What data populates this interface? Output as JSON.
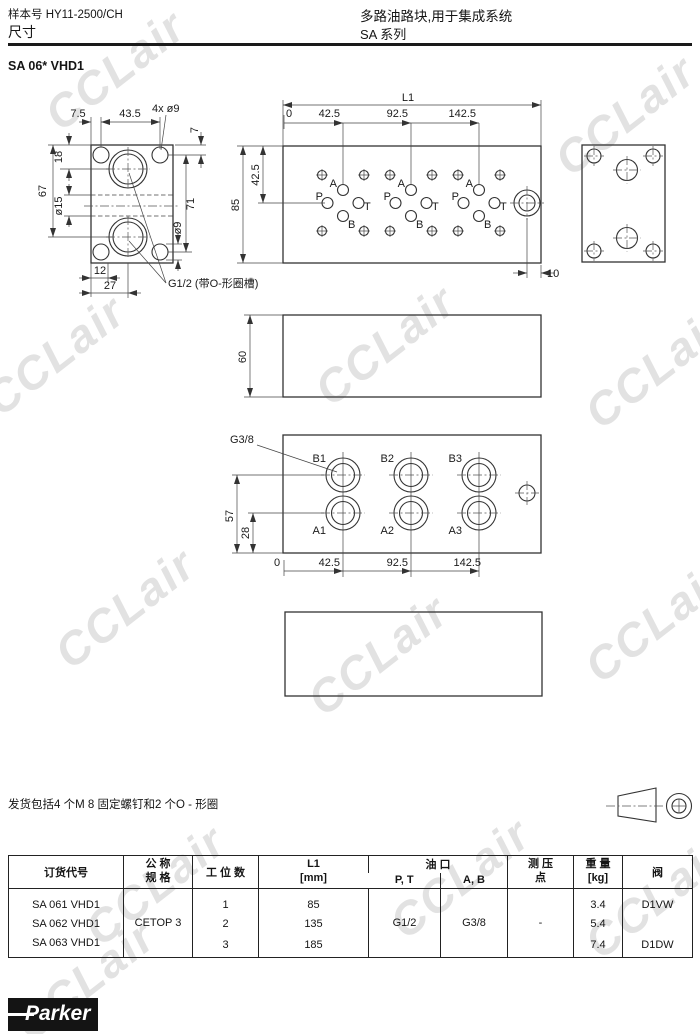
{
  "header": {
    "catalog": "样本号 HY11-2500/CH",
    "section": "尺寸",
    "title": "多路油路块,用于集成系统",
    "series": "SA  系列",
    "model": "SA 06* VHD1"
  },
  "front": {
    "d75": "7.5",
    "d435": "43.5",
    "holes": "4x ø9",
    "d7": "7",
    "d18": "18",
    "d67": "67",
    "d15": "ø15",
    "d71": "71",
    "d9": "ø9",
    "d12": "12",
    "d27": "27",
    "g12": "G1/2 (带O-形圈槽)"
  },
  "top": {
    "l1": "L1",
    "s0": "0",
    "s1": "42.5",
    "s2": "92.5",
    "s3": "142.5",
    "h85": "85",
    "h425": "42.5",
    "d10": "10",
    "a": "A",
    "p": "P",
    "t": "T",
    "b": "B"
  },
  "mid": {
    "d60": "60"
  },
  "ports": {
    "g38": "G3/8",
    "b1": "B1",
    "b2": "B2",
    "b3": "B3",
    "a1": "A1",
    "a2": "A2",
    "a3": "A3",
    "d57": "57",
    "d28": "28",
    "s0": "0",
    "s1": "42.5",
    "s2": "92.5",
    "s3": "142.5"
  },
  "note": {
    "text": "发货包括4 个M 8 固定螺钉和2 个O - 形圈"
  },
  "table": {
    "headers": {
      "order": "订货代号",
      "spec1": "公 称",
      "spec2": "规 格",
      "stations": "工 位 数",
      "l1a": "L1",
      "l1b": "[mm]",
      "oil": "油 口",
      "pt": "P, T",
      "ab": "A, B",
      "gauge1": "测 压",
      "gauge2": "点",
      "weight1": "重 量",
      "weight2": "[kg]",
      "valve": "阀"
    },
    "merged": {
      "spec": "CETOP 3",
      "pt": "G1/2",
      "ab": "G3/8",
      "gauge": "-"
    },
    "rows": [
      {
        "code": "SA 061 VHD1",
        "n": "1",
        "l1": "85",
        "kg": "3.4",
        "valve": "D1VW"
      },
      {
        "code": "SA 062 VHD1",
        "n": "2",
        "l1": "135",
        "kg": "5.4",
        "valve": ""
      },
      {
        "code": "SA 063 VHD1",
        "n": "3",
        "l1": "185",
        "kg": "7.4",
        "valve": "D1DW"
      }
    ]
  },
  "logo": {
    "text": "Parker"
  },
  "watermark": {
    "text": "CCLair"
  }
}
